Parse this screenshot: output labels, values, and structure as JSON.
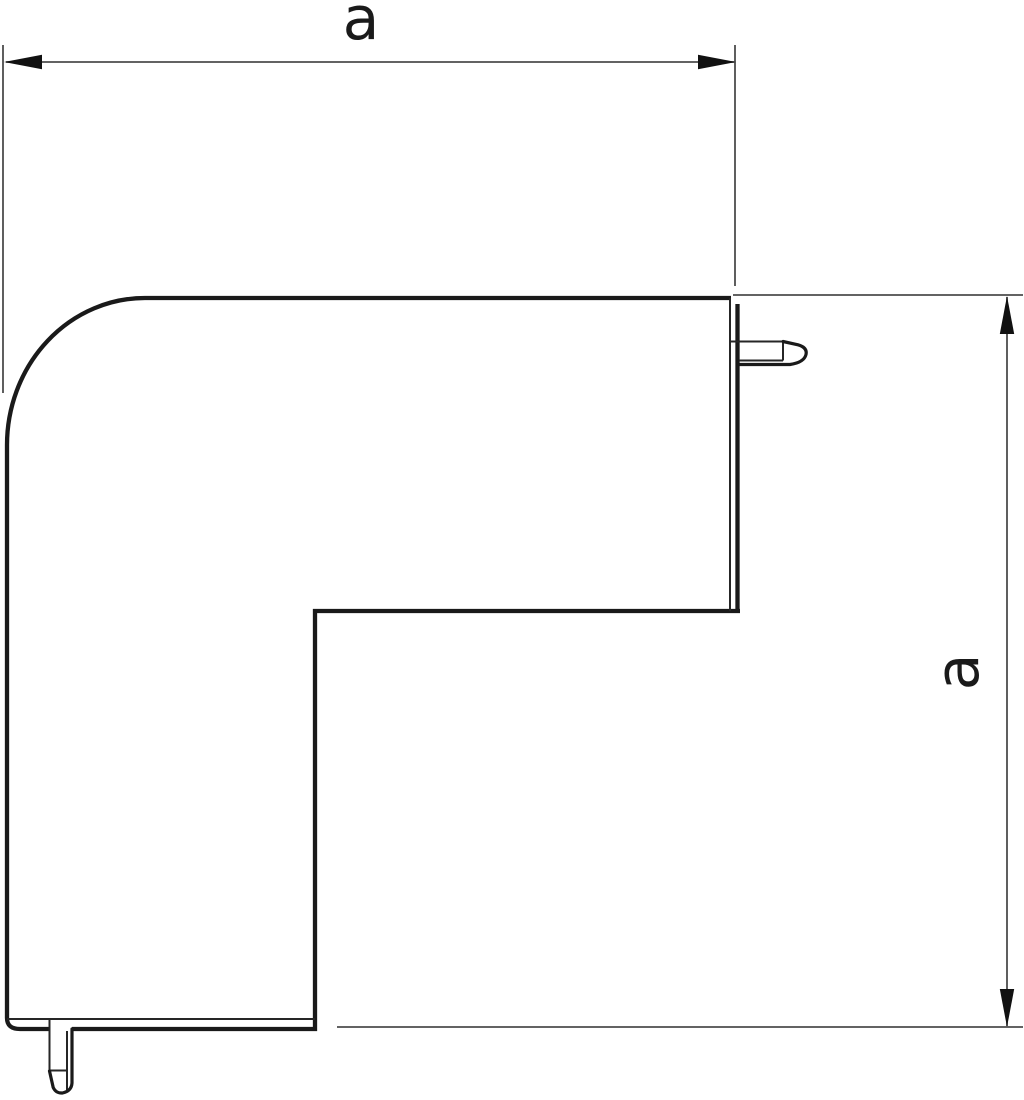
{
  "drawing": {
    "description": "Technical line drawing of a 90-degree flat corner cover (trunking angle piece) with latch pegs, dimensioned horizontally and vertically",
    "dimensions": {
      "horizontal": {
        "label": "a"
      },
      "vertical": {
        "label": "a"
      }
    },
    "colors": {
      "background": "#ffffff",
      "outline": "#1a1a1a",
      "thin_line": "#262626",
      "dimension_line": "#4d4d4d",
      "arrow": "#111111"
    }
  }
}
